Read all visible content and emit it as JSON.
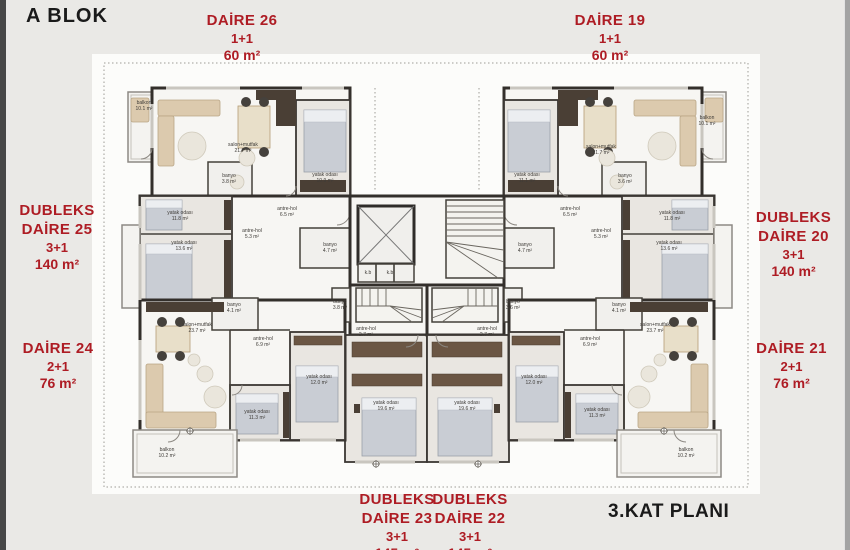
{
  "page": {
    "block_title": "A BLOK",
    "plan_title": "3.KAT PLANI"
  },
  "colors": {
    "unit_label_red": "#ae1c24",
    "title_black": "#1a1a1a",
    "wall_dark": "#332f2b"
  },
  "units": [
    {
      "prefix": "",
      "name": "DAİRE 26",
      "type": "1+1",
      "area": "60 m²"
    },
    {
      "prefix": "",
      "name": "DAİRE 19",
      "type": "1+1",
      "area": "60 m²"
    },
    {
      "prefix": "DUBLEKS",
      "name": "DAİRE 25",
      "type": "3+1",
      "area": "140 m²"
    },
    {
      "prefix": "DUBLEKS",
      "name": "DAİRE 20",
      "type": "3+1",
      "area": "140 m²"
    },
    {
      "prefix": "",
      "name": "DAİRE 24",
      "type": "2+1",
      "area": "76 m²"
    },
    {
      "prefix": "",
      "name": "DAİRE 21",
      "type": "2+1",
      "area": "76 m²"
    },
    {
      "prefix": "DUBLEKS",
      "name": "DAİRE 23",
      "type": "3+1",
      "area": "145 m²"
    },
    {
      "prefix": "DUBLEKS",
      "name": "DAİRE 22",
      "type": "3+1",
      "area": "145 m²"
    }
  ],
  "floorplan": {
    "rooms": [
      {
        "name": "balkon",
        "area": "10.1 m²",
        "x": 144,
        "y": 104
      },
      {
        "name": "salon+mutfak",
        "area": "21.7 m²",
        "x": 243,
        "y": 146
      },
      {
        "name": "yatak odası",
        "area": "10.9 m²",
        "x": 325,
        "y": 176
      },
      {
        "name": "banyo",
        "area": "3.8 m²",
        "x": 229,
        "y": 177
      },
      {
        "name": "antre-hol",
        "area": "6.5 m²",
        "x": 287,
        "y": 210
      },
      {
        "name": "yatak odası",
        "area": "11.8 m²",
        "x": 180,
        "y": 214
      },
      {
        "name": "antre-hol",
        "area": "5.3 m²",
        "x": 252,
        "y": 232
      },
      {
        "name": "yatak odası",
        "area": "13.6 m²",
        "x": 184,
        "y": 244
      },
      {
        "name": "banyo",
        "area": "4.7 m²",
        "x": 330,
        "y": 246
      },
      {
        "name": "banyo",
        "area": "3.8 m²",
        "x": 340,
        "y": 303
      },
      {
        "name": "antre-hol",
        "area": "2.7 m²",
        "x": 366,
        "y": 330
      },
      {
        "name": "yatak odası",
        "area": "19.6 m²",
        "x": 386,
        "y": 404
      },
      {
        "name": "salon+mutfak",
        "area": "23.7 m²",
        "x": 197,
        "y": 326
      },
      {
        "name": "banyo",
        "area": "4.1 m²",
        "x": 234,
        "y": 306
      },
      {
        "name": "antre-hol",
        "area": "6.9 m²",
        "x": 263,
        "y": 340
      },
      {
        "name": "yatak odası",
        "area": "12.0 m²",
        "x": 319,
        "y": 378
      },
      {
        "name": "yatak odası",
        "area": "11.3 m²",
        "x": 257,
        "y": 413
      },
      {
        "name": "balkon",
        "area": "10.2 m²",
        "x": 167,
        "y": 451
      },
      {
        "name": "k.b",
        "area": "",
        "x": 368,
        "y": 274
      },
      {
        "name": "k.b",
        "area": "",
        "x": 390,
        "y": 274
      },
      {
        "name": "balkon",
        "area": "10.1 m²",
        "x": 707,
        "y": 119
      },
      {
        "name": "salon+mutfak",
        "area": "21.7 m²",
        "x": 601,
        "y": 148
      },
      {
        "name": "yatak odası",
        "area": "11.1 m²",
        "x": 527,
        "y": 176
      },
      {
        "name": "banyo",
        "area": "3.6 m²",
        "x": 625,
        "y": 177
      },
      {
        "name": "antre-hol",
        "area": "6.5 m²",
        "x": 570,
        "y": 210
      },
      {
        "name": "yatak odası",
        "area": "11.8 m²",
        "x": 672,
        "y": 214
      },
      {
        "name": "antre-hol",
        "area": "5.3 m²",
        "x": 601,
        "y": 232
      },
      {
        "name": "yatak odası",
        "area": "13.6 m²",
        "x": 669,
        "y": 244
      },
      {
        "name": "banyo",
        "area": "4.7 m²",
        "x": 525,
        "y": 246
      },
      {
        "name": "banyo",
        "area": "3.6 m²",
        "x": 513,
        "y": 303
      },
      {
        "name": "antre-hol",
        "area": "2.7 m²",
        "x": 487,
        "y": 330
      },
      {
        "name": "yatak odası",
        "area": "19.6 m²",
        "x": 467,
        "y": 404
      },
      {
        "name": "salon+mutfak",
        "area": "23.7 m²",
        "x": 655,
        "y": 326
      },
      {
        "name": "banyo",
        "area": "4.1 m²",
        "x": 619,
        "y": 306
      },
      {
        "name": "antre-hol",
        "area": "6.9 m²",
        "x": 590,
        "y": 340
      },
      {
        "name": "yatak odası",
        "area": "12.0 m²",
        "x": 534,
        "y": 378
      },
      {
        "name": "yatak odası",
        "area": "11.3 m²",
        "x": 597,
        "y": 411
      },
      {
        "name": "balkon",
        "area": "10.2 m²",
        "x": 686,
        "y": 451
      }
    ]
  }
}
